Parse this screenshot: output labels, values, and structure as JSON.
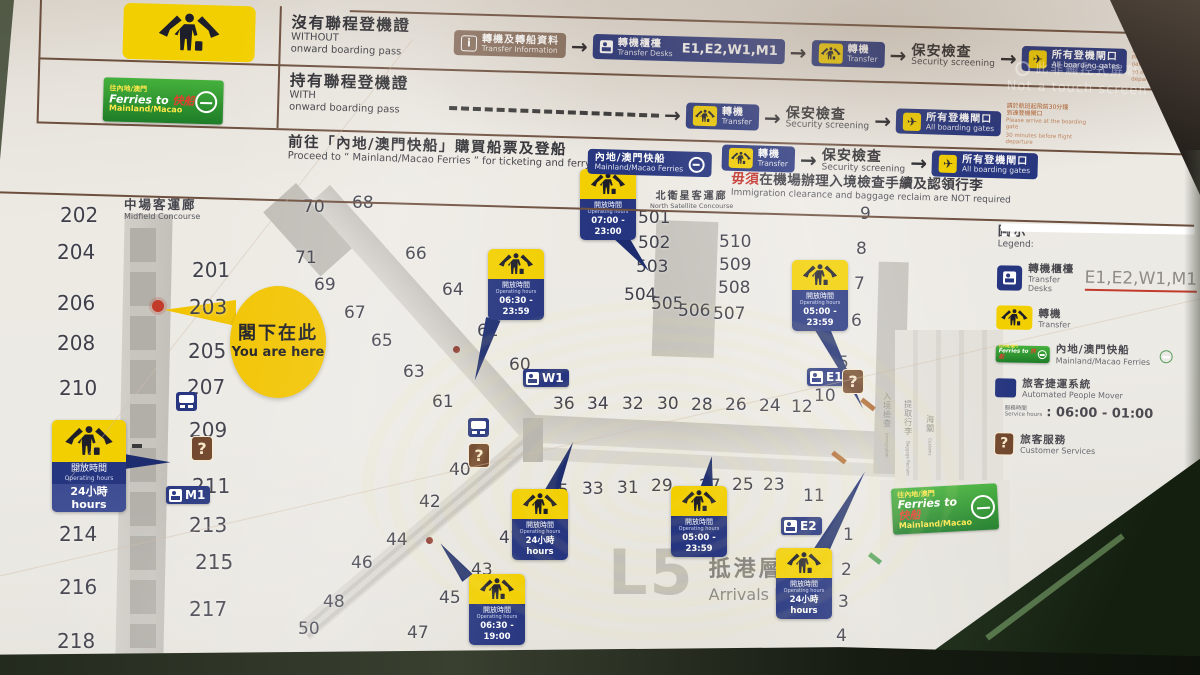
{
  "colors": {
    "sign_blue": "#26357f",
    "sign_yellow": "#f2cf00",
    "customer_brown": "#6f452a",
    "info_taupe": "#8b7262",
    "ferry_green": "#2f9e3f",
    "line_brown": "#6d4f3e",
    "accent_red": "#c23a2a",
    "board": "#eceae5",
    "gate_text": "#3f3f4a"
  },
  "watermark": {
    "zh": "此非觸控式屏幕",
    "en": "Not a touch screen"
  },
  "header": {
    "ferry_banner": {
      "l1": "往內地/澳門",
      "l2a": "Ferries to",
      "l2b": "快船",
      "l3": "Mainland/Macao"
    },
    "signs": {
      "info": {
        "zh": "轉機及轉船資料",
        "en": "Transfer Information",
        "icon": "info-icon"
      },
      "desks": {
        "zh": "轉機櫃檯",
        "en": "Transfer Desks",
        "codes": "E1,E2,W1,M1",
        "icon": "transfer-desk-icon"
      },
      "transfer": {
        "zh": "轉機",
        "en": "Transfer",
        "icon": "transfer-passenger-icon"
      },
      "security": {
        "zh": "保安檢查",
        "en": "Security screening"
      },
      "gates": {
        "zh": "所有登機閘口",
        "en": "All boarding gates",
        "icon": "plane-icon"
      },
      "ferries": {
        "zh": "內地/澳門快船",
        "en": "Mainland/Macao Ferries",
        "icon": "ferry-logo-icon"
      }
    },
    "rows": [
      {
        "zh": "沒有聯程登機證",
        "en1": "WITHOUT",
        "en2": "onward boarding pass"
      },
      {
        "zh": "持有聯程登機證",
        "en1": "WITH",
        "en2": "onward boarding pass"
      },
      {
        "zh": "前往「內地/澳門快船」購買船票及登船",
        "en1": "Proceed to “ Mainland/Macao Ferries ” for ticketing and ferry boarding"
      }
    ],
    "gate_note": {
      "zh1": "請於航班起飛前30分鐘",
      "zh2": "到達登機閘口",
      "en1": "Please arrive at the boarding gate",
      "en2": "30 minutes before flight departure"
    },
    "ferry_note": {
      "zh_red": "毋須",
      "zh": "在機場辦理入境檢查手續及認領行李",
      "en": "Immigration clearance and baggage reclaim are NOT required"
    }
  },
  "map": {
    "labels": {
      "midfield": {
        "zh": "中場客運廊",
        "en": "Midfield Concourse"
      },
      "north_satellite": {
        "zh": "北衛星客運廊",
        "en": "North Satellite Concourse"
      },
      "you_are_here": {
        "zh": "閣下在此",
        "en": "You are here"
      },
      "level": {
        "code": "L5",
        "zh": "抵港層",
        "en": "Arrivals level"
      }
    },
    "hall_labels": [
      {
        "zh": "入境檢查",
        "en": "Immigration",
        "x": 878,
        "y": 392
      },
      {
        "zh": "提取行李",
        "en": "Baggage Reclaim",
        "x": 899,
        "y": 400
      },
      {
        "zh": "海關",
        "en": "Customs",
        "x": 921,
        "y": 415
      }
    ],
    "gates": [
      {
        "label": "202",
        "x": 60,
        "y": 203,
        "cls": "g2"
      },
      {
        "label": "204",
        "x": 57,
        "y": 240,
        "cls": "g2"
      },
      {
        "label": "206",
        "x": 57,
        "y": 291,
        "cls": "g2"
      },
      {
        "label": "208",
        "x": 57,
        "y": 331,
        "cls": "g2"
      },
      {
        "label": "210",
        "x": 59,
        "y": 376,
        "cls": "g2"
      },
      {
        "label": "212",
        "x": 67,
        "y": 486,
        "cls": "g2"
      },
      {
        "label": "214",
        "x": 59,
        "y": 522,
        "cls": "g2"
      },
      {
        "label": "216",
        "x": 59,
        "y": 575,
        "cls": "g2"
      },
      {
        "label": "218",
        "x": 57,
        "y": 629,
        "cls": "g2"
      },
      {
        "label": "201",
        "x": 192,
        "y": 258,
        "cls": "g2"
      },
      {
        "label": "203",
        "x": 189,
        "y": 295,
        "cls": "g2"
      },
      {
        "label": "205",
        "x": 188,
        "y": 339,
        "cls": "g2"
      },
      {
        "label": "207",
        "x": 187,
        "y": 375,
        "cls": "g2"
      },
      {
        "label": "209",
        "x": 189,
        "y": 418,
        "cls": "g2"
      },
      {
        "label": "211",
        "x": 192,
        "y": 474,
        "cls": "g2"
      },
      {
        "label": "213",
        "x": 189,
        "y": 513,
        "cls": "g2"
      },
      {
        "label": "215",
        "x": 195,
        "y": 550,
        "cls": "g2"
      },
      {
        "label": "217",
        "x": 189,
        "y": 597,
        "cls": "g2"
      },
      {
        "label": "219",
        "x": 193,
        "y": 650,
        "cls": "g2"
      },
      {
        "label": "70",
        "x": 303,
        "y": 197
      },
      {
        "label": "68",
        "x": 352,
        "y": 193
      },
      {
        "label": "71",
        "x": 295,
        "y": 248
      },
      {
        "label": "69",
        "x": 314,
        "y": 275
      },
      {
        "label": "66",
        "x": 405,
        "y": 244
      },
      {
        "label": "67",
        "x": 344,
        "y": 303
      },
      {
        "label": "64",
        "x": 442,
        "y": 280
      },
      {
        "label": "65",
        "x": 371,
        "y": 331
      },
      {
        "label": "62",
        "x": 477,
        "y": 321
      },
      {
        "label": "63",
        "x": 403,
        "y": 362
      },
      {
        "label": "60",
        "x": 509,
        "y": 355
      },
      {
        "label": "61",
        "x": 432,
        "y": 392
      },
      {
        "label": "40",
        "x": 449,
        "y": 460
      },
      {
        "label": "42",
        "x": 419,
        "y": 492
      },
      {
        "label": "44",
        "x": 386,
        "y": 530
      },
      {
        "label": "46",
        "x": 351,
        "y": 553
      },
      {
        "label": "48",
        "x": 323,
        "y": 592
      },
      {
        "label": "50",
        "x": 298,
        "y": 619
      },
      {
        "label": "41",
        "x": 499,
        "y": 528
      },
      {
        "label": "43",
        "x": 471,
        "y": 560
      },
      {
        "label": "45",
        "x": 439,
        "y": 588
      },
      {
        "label": "47",
        "x": 407,
        "y": 623
      },
      {
        "label": "49",
        "x": 383,
        "y": 649
      },
      {
        "label": "36",
        "x": 553,
        "y": 394
      },
      {
        "label": "34",
        "x": 587,
        "y": 394
      },
      {
        "label": "32",
        "x": 622,
        "y": 394
      },
      {
        "label": "30",
        "x": 657,
        "y": 394
      },
      {
        "label": "28",
        "x": 691,
        "y": 395
      },
      {
        "label": "26",
        "x": 725,
        "y": 395
      },
      {
        "label": "24",
        "x": 759,
        "y": 396
      },
      {
        "label": "12",
        "x": 791,
        "y": 397
      },
      {
        "label": "10",
        "x": 814,
        "y": 386
      },
      {
        "label": "35",
        "x": 547,
        "y": 481
      },
      {
        "label": "33",
        "x": 582,
        "y": 479
      },
      {
        "label": "31",
        "x": 617,
        "y": 478
      },
      {
        "label": "29",
        "x": 651,
        "y": 476
      },
      {
        "label": "27",
        "x": 699,
        "y": 476
      },
      {
        "label": "25",
        "x": 732,
        "y": 475
      },
      {
        "label": "23",
        "x": 763,
        "y": 475
      },
      {
        "label": "11",
        "x": 803,
        "y": 486
      },
      {
        "label": "9",
        "x": 860,
        "y": 204
      },
      {
        "label": "8",
        "x": 856,
        "y": 239
      },
      {
        "label": "7",
        "x": 854,
        "y": 274
      },
      {
        "label": "6",
        "x": 851,
        "y": 311
      },
      {
        "label": "5",
        "x": 838,
        "y": 353
      },
      {
        "label": "1",
        "x": 843,
        "y": 525
      },
      {
        "label": "2",
        "x": 841,
        "y": 560
      },
      {
        "label": "3",
        "x": 838,
        "y": 592
      },
      {
        "label": "4",
        "x": 836,
        "y": 626
      },
      {
        "label": "501",
        "x": 638,
        "y": 208
      },
      {
        "label": "502",
        "x": 638,
        "y": 233
      },
      {
        "label": "503",
        "x": 636,
        "y": 257
      },
      {
        "label": "504",
        "x": 624,
        "y": 285
      },
      {
        "label": "505",
        "x": 651,
        "y": 294
      },
      {
        "label": "506",
        "x": 678,
        "y": 301
      },
      {
        "label": "507",
        "x": 713,
        "y": 304
      },
      {
        "label": "508",
        "x": 718,
        "y": 278
      },
      {
        "label": "509",
        "x": 719,
        "y": 255
      },
      {
        "label": "510",
        "x": 719,
        "y": 232
      }
    ],
    "desk_signs": [
      {
        "code": "W1",
        "x": 523,
        "y": 369
      },
      {
        "code": "M1",
        "x": 166,
        "y": 486
      },
      {
        "code": "E1",
        "x": 807,
        "y": 368
      },
      {
        "code": "E2",
        "x": 781,
        "y": 517
      }
    ],
    "hours_signs": [
      {
        "zh": "開放時間",
        "en": "Operating hours",
        "value": "24小時hours",
        "x": 52,
        "y": 420,
        "cls": "hs-big p-right"
      },
      {
        "zh": "開放時間",
        "en": "Operating hours",
        "value": "06:30 - 23:59",
        "x": 488,
        "y": 249,
        "cls": "p-diag"
      },
      {
        "zh": "開放時間",
        "en": "Operating hours",
        "value": "07:00 - 23:00",
        "x": 580,
        "y": 169,
        "cls": "p-nsat"
      },
      {
        "zh": "開放時間",
        "en": "Operating hours",
        "value": "05:00 - 23:59",
        "x": 792,
        "y": 260,
        "cls": "p-g7"
      },
      {
        "zh": "開放時間",
        "en": "Operating hours",
        "value": "24小時hours",
        "x": 512,
        "y": 489,
        "cls": "p-center"
      },
      {
        "zh": "開放時間",
        "en": "Operating hours",
        "value": "05:00 - 23:59",
        "x": 671,
        "y": 486,
        "cls": "p-g27"
      },
      {
        "zh": "開放時間",
        "en": "Operating hours",
        "value": "06:30 - 19:00",
        "x": 469,
        "y": 574,
        "cls": "p-bc"
      },
      {
        "zh": "開放時間",
        "en": "Operating hours",
        "value": "24小時hours",
        "x": 776,
        "y": 548,
        "cls": "p-e2"
      }
    ],
    "apm_icons": [
      {
        "x": 176,
        "y": 392
      },
      {
        "x": 468,
        "y": 418
      }
    ],
    "q_icons": [
      {
        "x": 191,
        "y": 436
      },
      {
        "x": 468,
        "y": 443
      },
      {
        "x": 842,
        "y": 369
      }
    ],
    "marks": [
      {
        "x": 860,
        "y": 402,
        "cls": "mk-esc"
      },
      {
        "x": 831,
        "y": 455,
        "cls": "mk-esc"
      },
      {
        "x": 868,
        "y": 556,
        "cls": "mk-green"
      },
      {
        "x": 453,
        "y": 346,
        "cls": "mk-dot"
      },
      {
        "x": 426,
        "y": 537,
        "cls": "mk-dot"
      },
      {
        "x": 132,
        "y": 444,
        "cls": "mk-tick"
      },
      {
        "x": 152,
        "y": 300,
        "cls": "mk-yah"
      }
    ]
  },
  "legend": {
    "title_zh": "圖示",
    "title_en": "Legend:",
    "desks": {
      "zh": "轉機櫃檯",
      "en": "Transfer Desks",
      "codes": "E1,E2,W1,M1"
    },
    "transfer": {
      "zh": "轉機",
      "en": "Transfer"
    },
    "ferries": {
      "zh": "內地/澳門快船",
      "en": "Mainland/Macao Ferries"
    },
    "apm": {
      "zh": "旅客捷運系統",
      "en": "Automated People Mover",
      "hours_zh": "服務時間",
      "hours_en": "Service hours",
      "value": ": 06:00 - 01:00"
    },
    "customer": {
      "zh": "旅客服務",
      "en": "Customer Services"
    }
  }
}
